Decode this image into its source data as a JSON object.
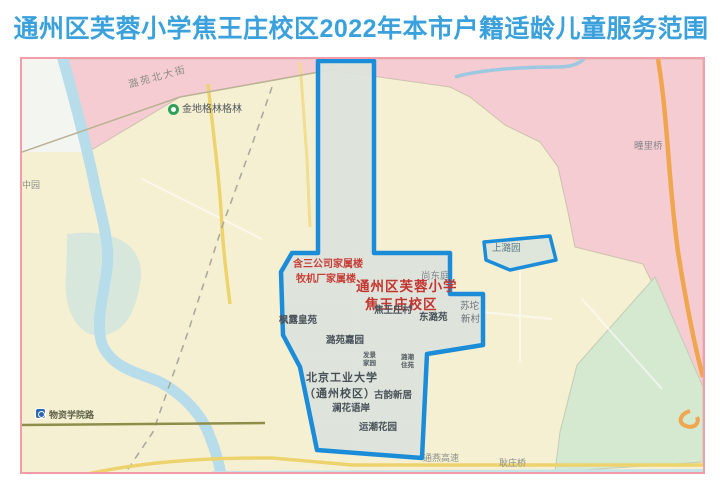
{
  "title": "通州区芙蓉小学焦王庄校区2022年本市户籍适龄儿童服务范围",
  "colors": {
    "title_blue": "#3BA1DC",
    "map_frame_pink": "#F49CA8",
    "boundary_blue": "#1B8CD8",
    "zone_pink": "#F5CBD2",
    "zone_yellow": "#F6F0D3",
    "zone_mint": "#D5E8D0",
    "zone_white": "#F4F6F1",
    "service_area_fill": "#DCE3DB",
    "river_blue": "#B7DCEA",
    "road_yellow": "#EDD36E",
    "road_orange": "#EFA64F",
    "label_red": "#C43430"
  },
  "map": {
    "icons": [
      {
        "id": "park-pin-icon",
        "name": "green place pin"
      },
      {
        "id": "metro-station-icon",
        "name": "subway station logo"
      }
    ],
    "labels": [
      {
        "id": "street-luyuan-north",
        "text": "潞苑北大街"
      },
      {
        "id": "poi-gemdale-green",
        "text": "金地格林格林"
      },
      {
        "id": "poi-zhongyuan",
        "text": "中园"
      },
      {
        "id": "bridge-tuanli",
        "text": "疃里桥"
      },
      {
        "id": "enclave-shangluyuan",
        "text": "上潞园"
      },
      {
        "id": "poi-shangdongting",
        "text": "尚东庭"
      },
      {
        "id": "poi-hansan-co-housing",
        "text": "含三公司家属楼"
      },
      {
        "id": "poi-muji-factory-housing",
        "text": "牧机厂家属楼"
      },
      {
        "id": "school-name-line1",
        "text": "通州区芙蓉小学"
      },
      {
        "id": "school-name-line2",
        "text": "焦王庄校区"
      },
      {
        "id": "village-jiaowangzhuang",
        "text": "焦王庄村"
      },
      {
        "id": "poi-dongluyuan",
        "text": "东潞苑"
      },
      {
        "id": "poi-sutuo-line1",
        "text": "苏坨"
      },
      {
        "id": "poi-sutuo-line2",
        "text": "新村"
      },
      {
        "id": "poi-fenglu-huangyuan",
        "text": "枫露皇苑"
      },
      {
        "id": "poi-luyuan-jiayuan",
        "text": "潞苑嘉园"
      },
      {
        "id": "poi-bjut-line1",
        "text": "北京工业大学"
      },
      {
        "id": "poi-bjut-line2",
        "text": "（通州校区）"
      },
      {
        "id": "poi-tiny1-line1",
        "text": "发景"
      },
      {
        "id": "poi-tiny1-line2",
        "text": "家园"
      },
      {
        "id": "poi-tiny2-line1",
        "text": "潞潮"
      },
      {
        "id": "poi-tiny2-line2",
        "text": "住苑"
      },
      {
        "id": "poi-guyun-xinju",
        "text": "古韵新居"
      },
      {
        "id": "poi-lanhua-yuan",
        "text": "澜花语岸"
      },
      {
        "id": "poi-yunchao-garden",
        "text": "运潮花园"
      },
      {
        "id": "metro-wuzixueyuanlu",
        "text": "物资学院路"
      },
      {
        "id": "road-tongyan-expwy",
        "text": "通燕高速"
      },
      {
        "id": "bridge-gengzhuang",
        "text": "耿庄桥"
      }
    ]
  }
}
